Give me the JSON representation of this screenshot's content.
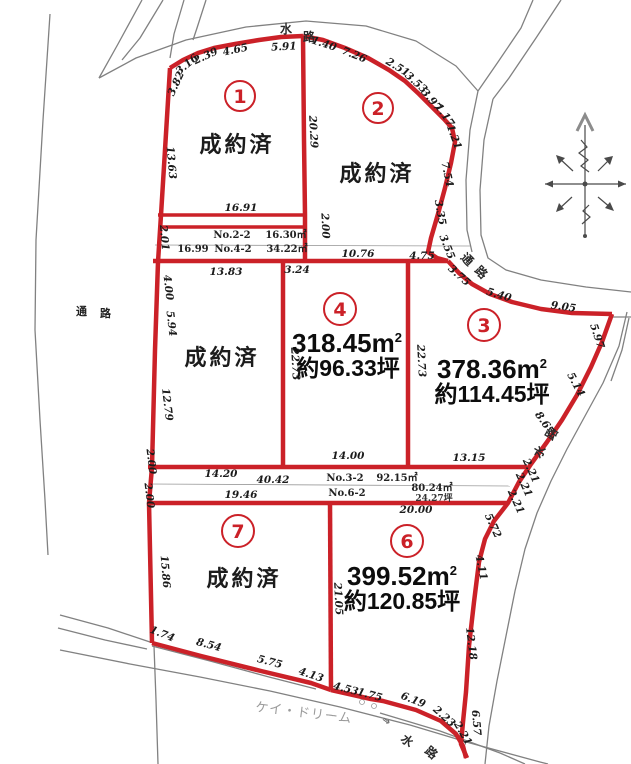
{
  "watermark": "ケイ・ドリーム",
  "kanji": {
    "water_top_1": "水",
    "water_top_2": "路",
    "road_right_1": "通",
    "road_right_2": "路",
    "road_left_1": "通",
    "road_left_2": "路",
    "water_right_1": "水",
    "water_right_2": "路",
    "water_bottom_1": "水",
    "water_bottom_2": "路",
    "flow_mark": "⇒"
  },
  "lots": {
    "lot1": {
      "no": "1",
      "status": "成約済"
    },
    "lot2": {
      "no": "2",
      "status": "成約済"
    },
    "lot3": {
      "no": "3",
      "area": "378.36m",
      "area_sup": "2",
      "tsubo": "約114.45坪"
    },
    "lot4": {
      "no": "4",
      "area": "318.45m",
      "area_sup": "2",
      "tsubo": "約96.33坪"
    },
    "lot6": {
      "no": "6",
      "area": "399.52m",
      "area_sup": "2",
      "tsubo": "約120.85坪"
    },
    "lot7": {
      "no": "7",
      "status": "成約済"
    },
    "lot_mid": {
      "status": "成約済"
    }
  },
  "strips": {
    "r1_label": "No.2-2",
    "r1_value": "16.30㎡",
    "r2_prefix": "16.99",
    "r2_label": "No.4-2",
    "r2_value": "34.22㎡",
    "r3_label": "No.3-2",
    "r3_value": "92.15㎡",
    "r4_label": "No.6-2",
    "r4_value": "80.24㎡",
    "r4_value2": "24.27坪"
  },
  "m": [
    "3.82",
    "3.16",
    "2.39",
    "4.65",
    "5.91",
    "1.40",
    "7.26",
    "2.51",
    "3.53",
    "3.97",
    "1.17",
    "1.21",
    "7.54",
    "3.35",
    "3.55",
    "13.63",
    "20.29",
    "16.91",
    "2.01",
    "2.00",
    "13.83",
    "3.24",
    "10.76",
    "4.75",
    "4.00",
    "5.94",
    "12.79",
    "2.00",
    "2.00",
    "22.73",
    "22.73",
    "14.00",
    "13.15",
    "3.75",
    "5.40",
    "9.05",
    "5.97",
    "5.14",
    "8.67",
    "14.20",
    "40.42",
    "19.46",
    "20.00",
    "2.21",
    "2.21",
    "2.21",
    "5.72",
    "4.11",
    "12.18",
    "6.57",
    "15.86",
    "21.05",
    "1.74",
    "8.54",
    "5.75",
    "4.13",
    "4.53",
    "1.75",
    "6.19",
    "2.23",
    "2.21"
  ]
}
